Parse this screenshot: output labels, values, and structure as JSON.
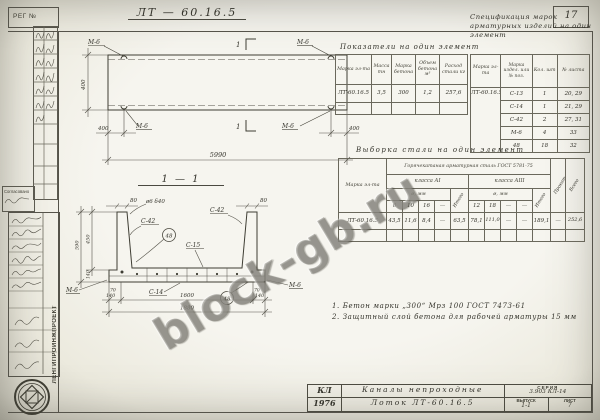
{
  "page": {
    "sheet_number": "17",
    "reg_label": "РЕГ №",
    "soglasovano": "Согласовано",
    "org": "ЛЕНГИПРОИНЖПРОЕКТ"
  },
  "drawing_title": "ЛТ — 60.16.5",
  "watermark": {
    "text": "block-gb.ru"
  },
  "elevation": {
    "loop_label": "М-6",
    "section_mark": "1",
    "dims": {
      "height": "400",
      "end": "400",
      "length": "5990"
    }
  },
  "section": {
    "title": "1 — 1",
    "labels": {
      "c42": "С-42",
      "c15": "С-15",
      "c14": "С-14",
      "pos": "48",
      "m6": "М-6",
      "wall": "80",
      "anchor": "ø6 δ40"
    },
    "dims": {
      "total_h": "590",
      "wall_h": "450",
      "base_h": "140",
      "flange": "140",
      "inner": "1600",
      "total_w": "1880",
      "foot": "70"
    }
  },
  "indicators_table": {
    "title": "Показатели на один элемент",
    "headers": [
      "Марка эл-та",
      "Масса тн",
      "Марка бетона",
      "Объем бетона м³",
      "Расход стали кг"
    ],
    "row": [
      "ЛТ-60.16.5",
      "3,5",
      "300",
      "1,2",
      "257,6"
    ]
  },
  "spec_table": {
    "title": "Спецификация марок арматурных изделий на один элемент",
    "headers": [
      "Марка эл-та",
      "Марка издел. или № поз.",
      "Кол. шт",
      "№ листа"
    ],
    "mark": "ЛТ-60.16.5",
    "rows": [
      {
        "item": "С-13",
        "qty": "1",
        "sheet": "20, 29"
      },
      {
        "item": "С-14",
        "qty": "1",
        "sheet": "21, 29"
      },
      {
        "item": "С-42",
        "qty": "2",
        "sheet": "27, 31"
      },
      {
        "item": "М-6",
        "qty": "4",
        "sheet": "33"
      },
      {
        "item": "48",
        "qty": "18",
        "sheet": "32"
      }
    ]
  },
  "steel_table": {
    "title": "Выборка стали на один элемент",
    "gost_header": "Горячекатаная арматурная сталь ГОСТ 5781-75",
    "mark_header": "Марка эл-та",
    "class_a1": "класса АI",
    "class_a3": "класса АIII",
    "dia_label": "ø, мм",
    "itogo_label": "Итого",
    "prokat_label": "Прокат",
    "vsego_label": "Всего",
    "dias_a1": [
      "6",
      "10",
      "16",
      "—"
    ],
    "dias_a3": [
      "12",
      "18",
      "—",
      "—"
    ],
    "row": {
      "mark": "ЛТ-60.16.5",
      "a1_0": "43,5",
      "a1_1": "11,6",
      "a1_2": "8,4",
      "a1_3": "—",
      "a1_total": "63,5",
      "a3_0": "78,1",
      "a3_1": "111,0",
      "a3_2": "—",
      "a3_3": "—",
      "a3_total": "189,1",
      "prokat": "—",
      "total": "252,6"
    }
  },
  "notes": {
    "n1": "1. Бетон марки „300“ Мрз 100  ГОСТ 7473-61",
    "n2": "2. Защитный слой бетона для рабочей арматуры 15 мм"
  },
  "title_block": {
    "code": "КЛ",
    "year": "1976",
    "object": "Каналы непроходные",
    "item": "Лоток ЛТ-60.16.5",
    "series_label": "СЕРИЯ",
    "series": "3.903 КЛ-14",
    "issue_label": "ВЫПУСК",
    "issue": "1-1",
    "sheet_label": "ЛИСТ",
    "sheet": "7"
  }
}
